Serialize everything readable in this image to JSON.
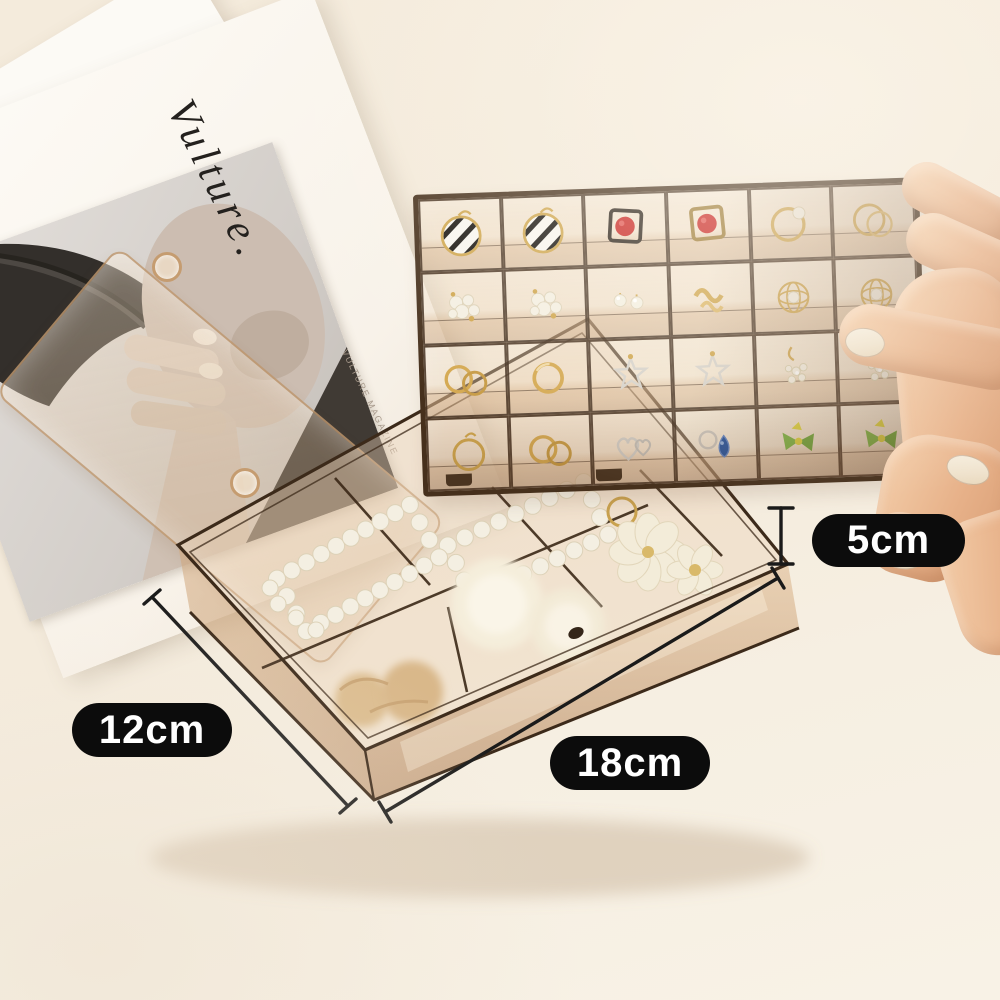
{
  "scene": {
    "description": "Product photo: transparent amber acrylic jewelry organizer box with a removable 24-grid earring tray held by a hand, base compartments holding pearl hair clips, fur pom-pom ties and a flower hair tie, with a fashion magazine in the background",
    "background_color": "#f4ebdc"
  },
  "annotations": {
    "height_label": "5cm",
    "depth_label": "12cm",
    "width_label": "18cm",
    "label_bg": "#0c0c0c",
    "label_text_color": "#ffffff",
    "line_color": "#1a1a1a"
  },
  "magazine": {
    "title": "Vulture.",
    "caption": "VULTURE MAGAZINE"
  },
  "materials": {
    "plastic_tint": "#c49a6c",
    "frame_line": "#42301e",
    "gold": "#cfa64e",
    "pearl": "#f4efe2",
    "silver": "#d2cec7",
    "red": "#c8221f",
    "blue": "#1d4f9e",
    "green": "#79b840",
    "yellow": "#dfd63a",
    "skin": "#eec19e"
  },
  "tray": {
    "rows": 4,
    "cols": 6,
    "cells": [
      {
        "type": "striped-hoop",
        "item": "black striped disc hoop earring"
      },
      {
        "type": "striped-hoop",
        "item": "black striped disc hoop earring"
      },
      {
        "type": "red-square",
        "item": "red stud in black square frame"
      },
      {
        "type": "red-square-gold",
        "item": "red stud in gold square frame"
      },
      {
        "type": "hoop-pearl",
        "item": "gold hoop with pearl"
      },
      {
        "type": "double-hoop",
        "item": "double gold hoop earring"
      },
      {
        "type": "pearl-cluster",
        "item": "pearl cluster earrings"
      },
      {
        "type": "pearl-cluster",
        "item": "pearl and crystal cluster"
      },
      {
        "type": "pearl-stud",
        "item": "pearl stud earrings"
      },
      {
        "type": "gold-knot",
        "item": "gold knot studs"
      },
      {
        "type": "wire-ball",
        "item": "gold wire ball with pearl"
      },
      {
        "type": "wire-ball",
        "item": "gold wire ball earring"
      },
      {
        "type": "gold-rings",
        "item": "pair of gold rings"
      },
      {
        "type": "gold-ring",
        "item": "gold twist ring"
      },
      {
        "type": "silver-star",
        "item": "silver wire star earring"
      },
      {
        "type": "silver-star",
        "item": "silver wire star earring"
      },
      {
        "type": "crystal-dangle",
        "item": "crystal drop earring"
      },
      {
        "type": "crystal-dangle",
        "item": "crystal flower earring"
      },
      {
        "type": "gold-hoop",
        "item": "gold hoop earring"
      },
      {
        "type": "gold-rings",
        "item": "gold band rings"
      },
      {
        "type": "silver-heart",
        "item": "silver heart earrings"
      },
      {
        "type": "blue-gem",
        "item": "blue teardrop gem ring"
      },
      {
        "type": "green-bow",
        "item": "green bow with yellow ribbon earring"
      },
      {
        "type": "green-bow",
        "item": "green bow with yellow ribbon earring"
      }
    ]
  },
  "box": {
    "contents": [
      "pearl rectangle hair clip",
      "pearl rectangle hair clip",
      "white fur pom-pom hair ties",
      "pearl flower hair tie",
      "tan plush scrunchie"
    ]
  }
}
